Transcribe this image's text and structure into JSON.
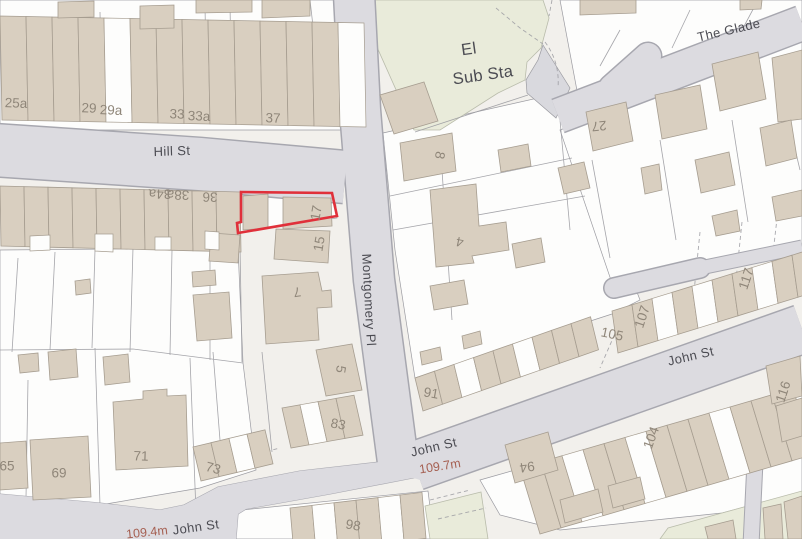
{
  "map": {
    "type": "street-map-screenshot",
    "selected_property": {
      "description": "red outlined plot 15-17 Hill St / Montgomery Pl corner",
      "outline_points": "241,192 332,193 337,216 238,233 237,223 241,222"
    },
    "colors": {
      "road_fill": "#dcdbe0",
      "road_casing": "#a7a7af",
      "building": "#d9cfc0",
      "building_line": "#a69d90",
      "parcel_white": "#fdfdfc",
      "parcel_beige": "#efede8",
      "parcel_line": "#9b9ba1",
      "green_area": "#e9ebda",
      "base": "#f2f0ec",
      "street_ink": "#4b4b52",
      "number_ink": "#8f8679",
      "elev_ink": "#a55f51",
      "selection": "#e0303a"
    },
    "labels": [
      {
        "kind": "street",
        "text": "Hill St",
        "x": 172,
        "y": 152,
        "rot": -2
      },
      {
        "kind": "street",
        "text": "Montgomery Pl",
        "x": 368,
        "y": 300,
        "rot": 87
      },
      {
        "kind": "street",
        "text": "John St",
        "x": 196,
        "y": 528,
        "rot": -8
      },
      {
        "kind": "street",
        "text": "John St",
        "x": 434,
        "y": 448,
        "rot": -13
      },
      {
        "kind": "street",
        "text": "John St",
        "x": 691,
        "y": 357,
        "rot": -13
      },
      {
        "kind": "street",
        "text": "The Glade",
        "x": 729,
        "y": 31,
        "rot": -13
      },
      {
        "kind": "area",
        "text": "El",
        "x": 469,
        "y": 50,
        "rot": -8
      },
      {
        "kind": "area",
        "text": "Sub Sta",
        "x": 483,
        "y": 76,
        "rot": -8
      },
      {
        "kind": "elev",
        "text": "109.4m",
        "x": 147,
        "y": 533,
        "rot": -6
      },
      {
        "kind": "elev",
        "text": "109.7m",
        "x": 440,
        "y": 467,
        "rot": -9
      },
      {
        "kind": "number",
        "text": "25a",
        "x": 16,
        "y": 104,
        "rot": 2
      },
      {
        "kind": "number",
        "text": "29",
        "x": 89,
        "y": 109,
        "rot": 2
      },
      {
        "kind": "number",
        "text": "29a",
        "x": 111,
        "y": 111,
        "rot": 2
      },
      {
        "kind": "number",
        "text": "33",
        "x": 177,
        "y": 115,
        "rot": 2
      },
      {
        "kind": "number",
        "text": "33a",
        "x": 199,
        "y": 117,
        "rot": 2
      },
      {
        "kind": "number",
        "text": "37",
        "x": 273,
        "y": 119,
        "rot": 2
      },
      {
        "kind": "number",
        "text": "34a",
        "x": 160,
        "y": 193,
        "rot": 181
      },
      {
        "kind": "number",
        "text": "38a",
        "x": 178,
        "y": 194,
        "rot": 181
      },
      {
        "kind": "number",
        "text": "36",
        "x": 210,
        "y": 196,
        "rot": 181
      },
      {
        "kind": "number",
        "text": "17",
        "x": 317,
        "y": 213,
        "rot": -80
      },
      {
        "kind": "number",
        "text": "15",
        "x": 320,
        "y": 244,
        "rot": -80
      },
      {
        "kind": "number",
        "text": "7",
        "x": 297,
        "y": 291,
        "rot": 172
      },
      {
        "kind": "number",
        "text": "5",
        "x": 340,
        "y": 369,
        "rot": 100
      },
      {
        "kind": "number",
        "text": "83",
        "x": 338,
        "y": 425,
        "rot": 10
      },
      {
        "kind": "number",
        "text": "71",
        "x": 141,
        "y": 457,
        "rot": 2
      },
      {
        "kind": "number",
        "text": "73",
        "x": 213,
        "y": 469,
        "rot": 14
      },
      {
        "kind": "number",
        "text": "69",
        "x": 59,
        "y": 474,
        "rot": 0
      },
      {
        "kind": "number",
        "text": "65",
        "x": 7,
        "y": 467,
        "rot": 0
      },
      {
        "kind": "number",
        "text": "98",
        "x": 353,
        "y": 526,
        "rot": 10
      },
      {
        "kind": "number",
        "text": "91",
        "x": 431,
        "y": 394,
        "rot": 10
      },
      {
        "kind": "number",
        "text": "8",
        "x": 439,
        "y": 155,
        "rot": 100
      },
      {
        "kind": "number",
        "text": "4",
        "x": 460,
        "y": 241,
        "rot": 192
      },
      {
        "kind": "number",
        "text": "27",
        "x": 599,
        "y": 125,
        "rot": 175
      },
      {
        "kind": "number",
        "text": "105",
        "x": 612,
        "y": 335,
        "rot": 12
      },
      {
        "kind": "number",
        "text": "107",
        "x": 643,
        "y": 317,
        "rot": -72
      },
      {
        "kind": "number",
        "text": "117",
        "x": 747,
        "y": 279,
        "rot": -72
      },
      {
        "kind": "number",
        "text": "116",
        "x": 784,
        "y": 392,
        "rot": -72
      },
      {
        "kind": "number",
        "text": "104",
        "x": 652,
        "y": 438,
        "rot": -70
      },
      {
        "kind": "number",
        "text": "94",
        "x": 527,
        "y": 466,
        "rot": 172
      }
    ]
  }
}
